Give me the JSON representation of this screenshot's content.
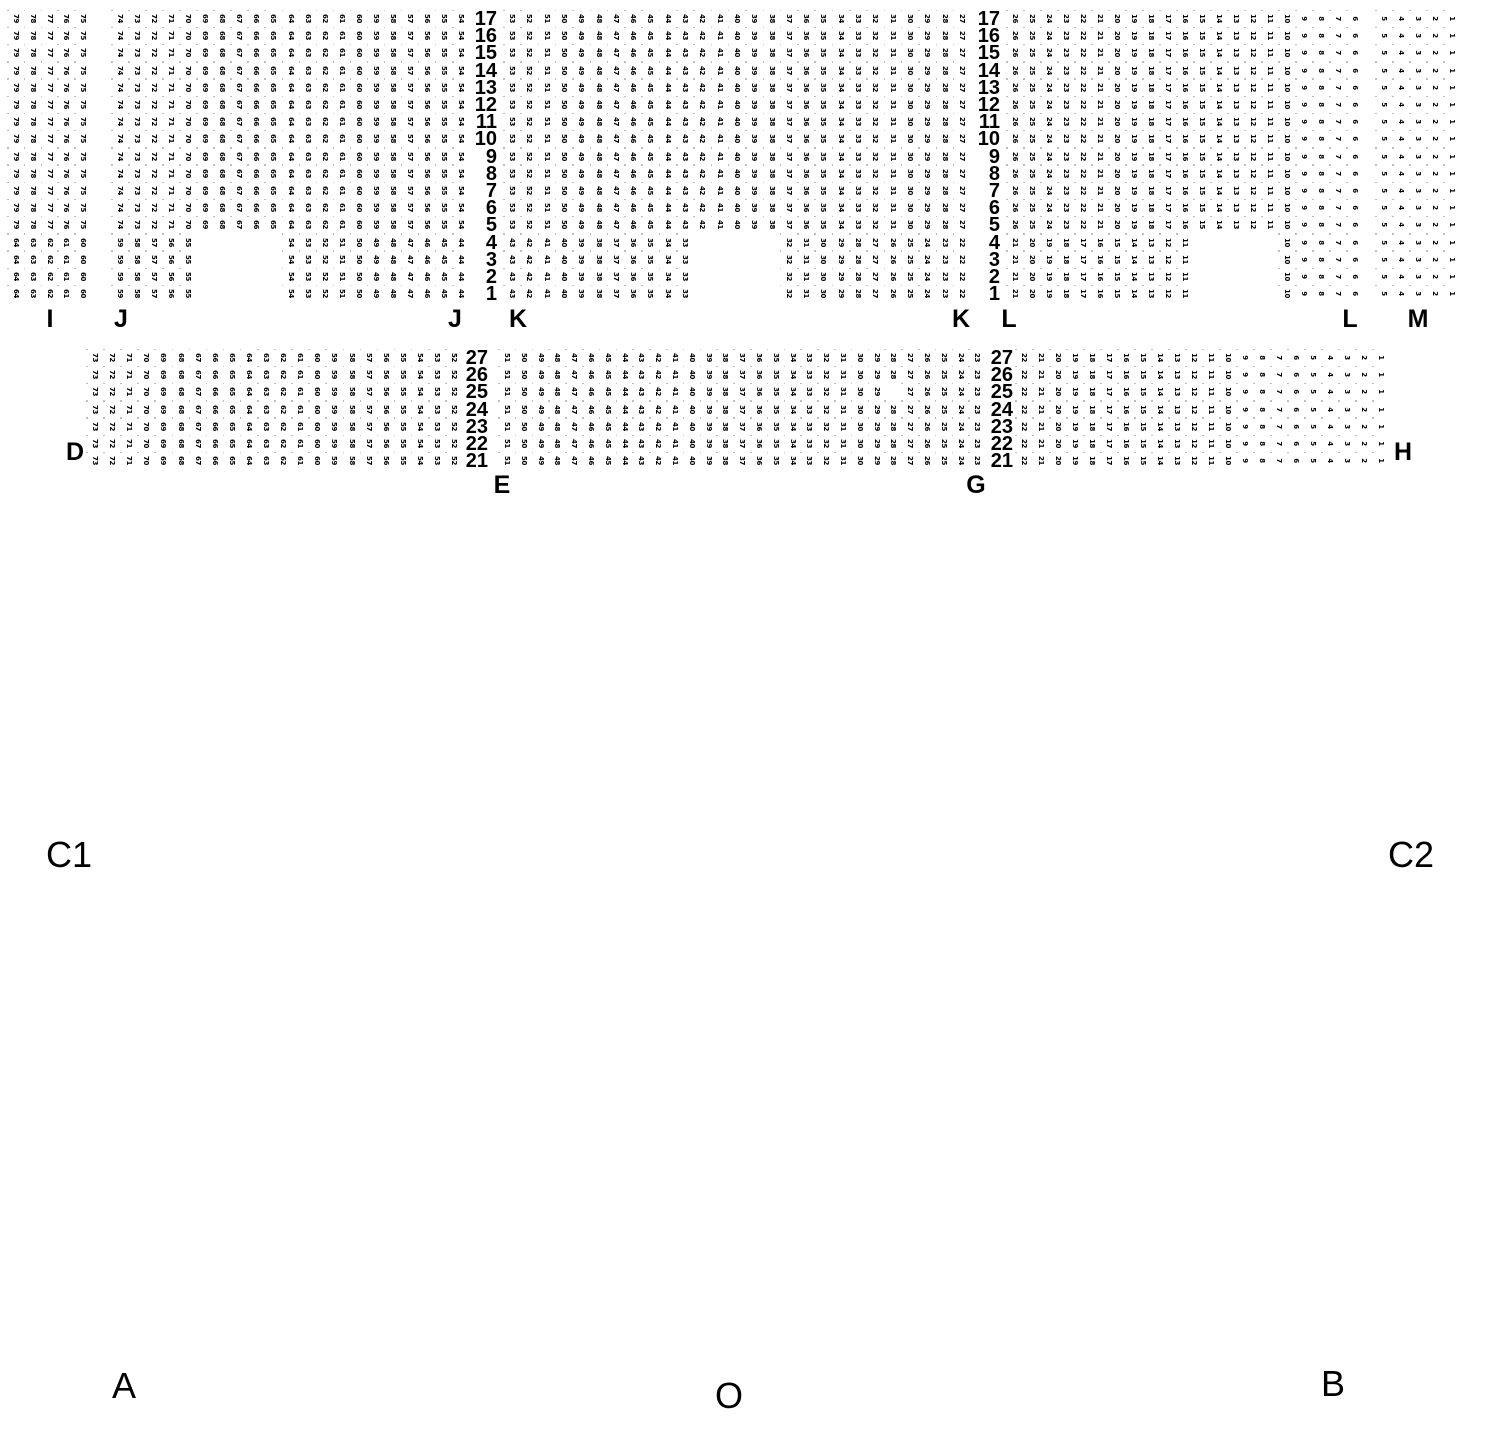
{
  "colors": {
    "background": "#ffffff",
    "seat_number": "#000000",
    "label": "#000000",
    "seat_dot": "#b3b3b3"
  },
  "seat_grid": {
    "cell_width": 17.1,
    "cell_height": 17.2,
    "seat_font_size": 7,
    "seat_rotation_deg": 90
  },
  "blocks": [
    {
      "id": "upper",
      "y": 11,
      "row_start": 17,
      "row_end": 1,
      "row_label_right_x": [
        497,
        1000
      ],
      "sections": [
        {
          "label": "I",
          "x": 9,
          "cols": 5,
          "spacing": 16.8
        },
        {
          "label": "J",
          "x": 113,
          "cols": 21,
          "spacing": 17.05
        },
        {
          "label": "K",
          "x": 505,
          "cols": 27,
          "spacing": 17.3
        },
        {
          "label": "L",
          "x": 1008,
          "cols": 21,
          "spacing": 17.0
        },
        {
          "label": "M",
          "x": 1377,
          "cols": 5,
          "spacing": 17.0
        }
      ],
      "numbering": [
        {
          "row_high": 17,
          "row_low": 5,
          "start_seat": 79,
          "occupied": null
        },
        {
          "row_high": 4,
          "row_low": 1,
          "start_seat": 64,
          "occupied": {
            "I": [
              [
                0,
                4
              ]
            ],
            "J": [
              [
                0,
                4
              ],
              [
                10,
                20
              ]
            ],
            "K": [
              [
                0,
                10
              ],
              [
                16,
                26
              ]
            ],
            "L": [
              [
                0,
                10
              ],
              [
                16,
                20
              ]
            ],
            "M": [
              [
                0,
                4
              ]
            ]
          }
        }
      ],
      "missing_seats": [],
      "section_labels": [
        {
          "text": "I",
          "cx": 50,
          "y": 307
        },
        {
          "text": "J",
          "cx": 121,
          "y": 307
        },
        {
          "text": "J",
          "cx": 455,
          "y": 307
        },
        {
          "text": "K",
          "cx": 518,
          "y": 307
        },
        {
          "text": "K",
          "cx": 961,
          "y": 307
        },
        {
          "text": "L",
          "cx": 1009,
          "y": 307
        },
        {
          "text": "L",
          "cx": 1350,
          "y": 307
        },
        {
          "text": "M",
          "cx": 1418,
          "y": 307
        }
      ]
    },
    {
      "id": "lower",
      "y": 350,
      "row_start": 27,
      "row_end": 21,
      "row_label_right_x": [
        488,
        1013
      ],
      "sections": [
        {
          "label": "D",
          "x": 88,
          "cols": 22,
          "spacing": 17.1
        },
        {
          "label": "EG",
          "x": 500,
          "cols": 29,
          "spacing": 16.8
        },
        {
          "label": "H",
          "x": 1017,
          "cols": 22,
          "spacing": 17.0
        }
      ],
      "numbering": [
        {
          "row_high": 27,
          "row_low": 21,
          "start_seat": 73,
          "occupied": null
        }
      ],
      "missing_seats": [
        {
          "row": 25,
          "seat": 28
        }
      ],
      "section_labels": [
        {
          "text": "D",
          "cx": 75,
          "y": 440
        },
        {
          "text": "E",
          "cx": 502,
          "y": 473
        },
        {
          "text": "G",
          "cx": 976,
          "y": 473
        },
        {
          "text": "H",
          "cx": 1403,
          "y": 440
        }
      ]
    }
  ],
  "area_labels": [
    {
      "text": "C1",
      "cx": 69,
      "y": 837
    },
    {
      "text": "C2",
      "cx": 1411,
      "y": 837
    },
    {
      "text": "A",
      "cx": 124,
      "y": 1368
    },
    {
      "text": "O",
      "cx": 729,
      "y": 1378
    },
    {
      "text": "B",
      "cx": 1333,
      "y": 1366
    }
  ]
}
